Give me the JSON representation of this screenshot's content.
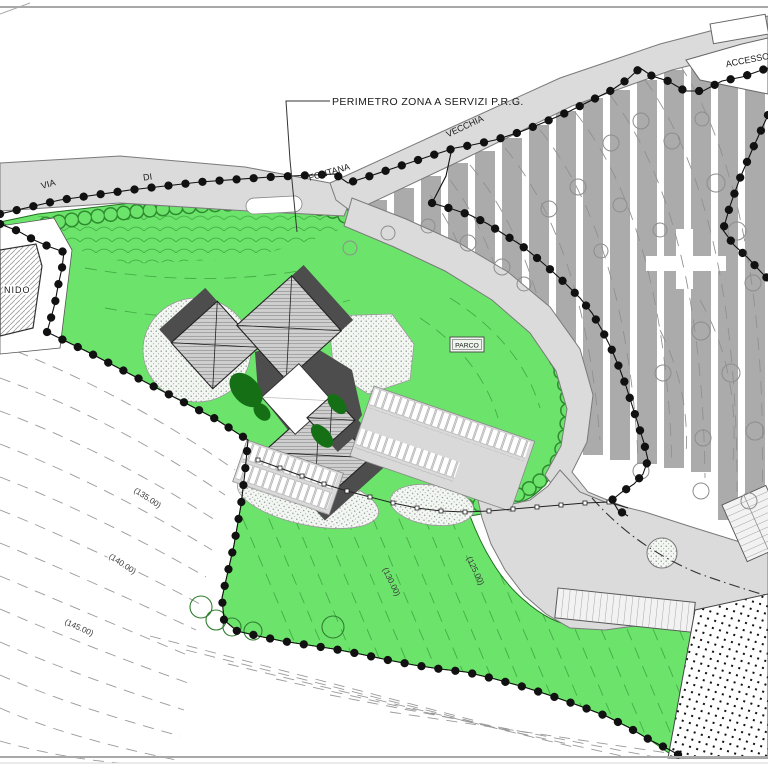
{
  "plan": {
    "callout": "PERIMETRO ZONA A SERVIZI P.R.G.",
    "street_words": [
      "VIA",
      "DI",
      "FONTANA",
      "VECCHIA"
    ],
    "access_label": "ACCESSO",
    "building_label": "NIDO",
    "park_label": "PARCO",
    "contour_elevations": [
      "(135.00)",
      "(140.00)",
      "(145.00)",
      "(130.00)",
      "(125.00)"
    ],
    "colors": {
      "park_green": "#6ce46c",
      "road_gray": "#dbdbdb",
      "terrace_gray": "#ababab",
      "roof_gray": "#cfcfcf",
      "wall_dark": "#4d4d4d",
      "hedge_dark_green": "#157015",
      "boundary_black": "#111111"
    }
  }
}
